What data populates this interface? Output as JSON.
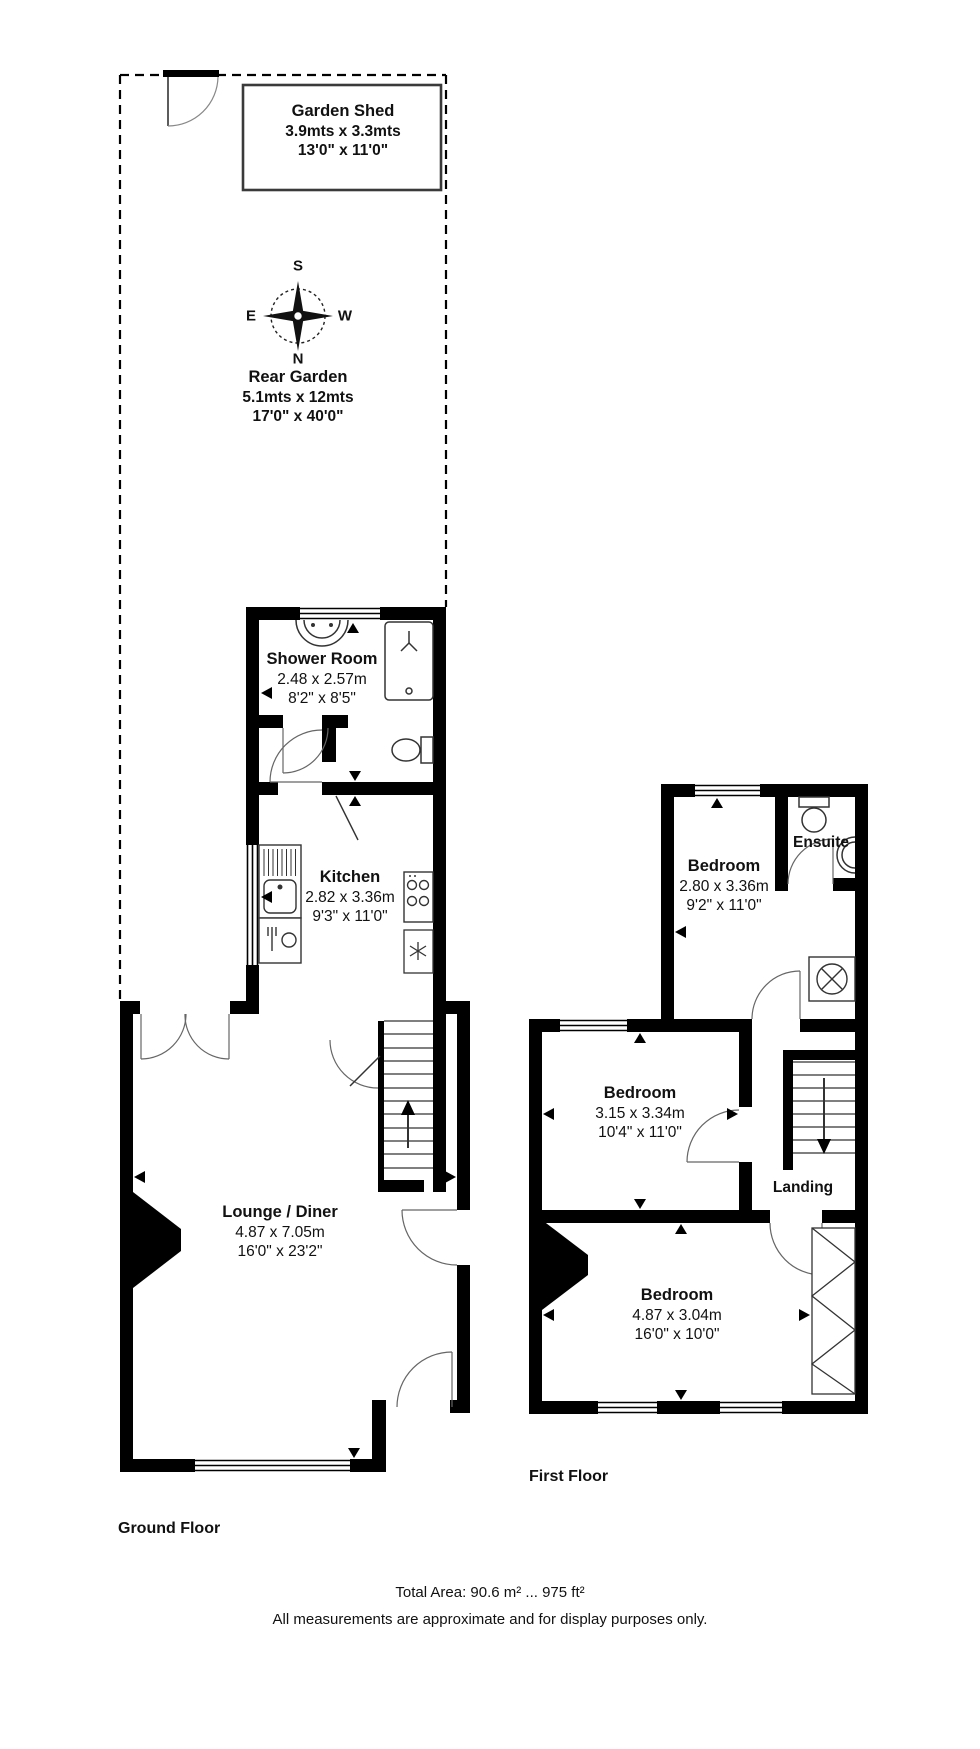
{
  "palette": {
    "wall": "#000000",
    "bg": "#ffffff",
    "door_line": "#666666",
    "fixture_line": "#333333",
    "text": "#111111"
  },
  "compass": {
    "n": "N",
    "s": "S",
    "e": "E",
    "w": "W"
  },
  "garden": {
    "shed": {
      "name": "Garden Shed",
      "metric": "3.9mts x 3.3mts",
      "imperial": "13'0\" x 11'0\""
    },
    "lawn": {
      "name": "Rear Garden",
      "metric": "5.1mts x 12mts",
      "imperial": "17'0\" x 40'0\""
    }
  },
  "ground_floor": {
    "label": "Ground Floor",
    "shower_room": {
      "name": "Shower Room",
      "metric": "2.48 x 2.57m",
      "imperial": "8'2\" x 8'5\""
    },
    "kitchen": {
      "name": "Kitchen",
      "metric": "2.82 x 3.36m",
      "imperial": "9'3\" x 11'0\""
    },
    "lounge": {
      "name": "Lounge / Diner",
      "metric": "4.87 x 7.05m",
      "imperial": "16'0\" x 23'2\""
    }
  },
  "first_floor": {
    "label": "First Floor",
    "bedroom1": {
      "name": "Bedroom",
      "metric": "2.80 x 3.36m",
      "imperial": "9'2\" x 11'0\""
    },
    "ensuite": {
      "name": "Ensuite"
    },
    "bedroom2": {
      "name": "Bedroom",
      "metric": "3.15 x 3.34m",
      "imperial": "10'4\" x 11'0\""
    },
    "landing": {
      "name": "Landing"
    },
    "bedroom3": {
      "name": "Bedroom",
      "metric": "4.87 x 3.04m",
      "imperial": "16'0\" x 10'0\""
    }
  },
  "footer": {
    "total_area": "Total Area: 90.6 m² ... 975 ft²",
    "disclaimer": "All measurements are approximate and for display purposes only."
  }
}
